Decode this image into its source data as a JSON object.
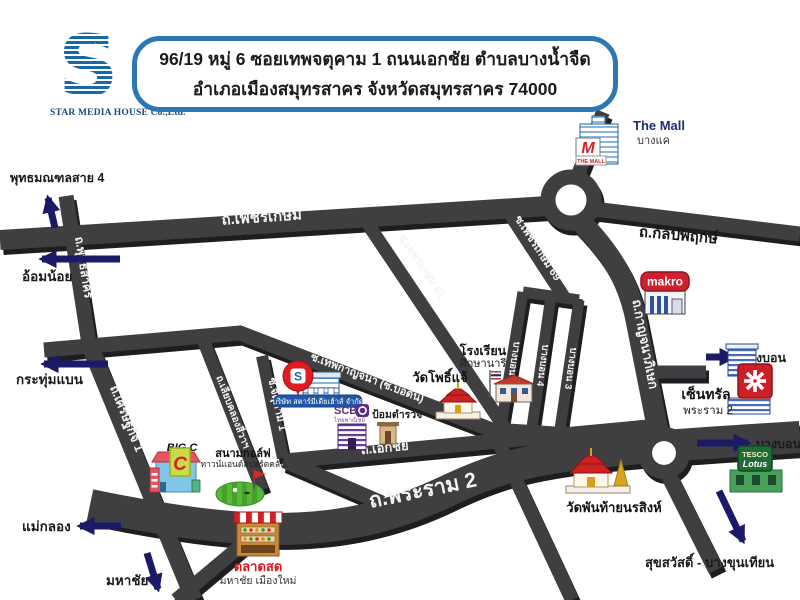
{
  "header": {
    "logo_letter": "S",
    "logo_star": "★",
    "company": "STAR MEDIA HOUSE Co.,Ltd.",
    "address_line1": "96/19 หมู่ 6 ซอยเทพจตุคาม 1 ถนนเอกชัย ตำบลบางน้ำจืด",
    "address_line2": "อำเภอเมืองสมุทรสาคร จังหวัดสมุทรสาคร 74000"
  },
  "roads": {
    "phetkasem": "ถ.เพชรเกษม",
    "kanlapaphruek": "ถ.กัลปพฤกษ์",
    "kanchanaphisek": "ถ.กาญจนาภิเษก",
    "phetkasem81": "ซ.เพชรเกษม 81",
    "phetkasem69": "ซ.เพชรเกษม 69",
    "bangbon5": "บางบอน 5",
    "bangbon4": "บางบอน 4",
    "bangbon3": "บางบอน 3",
    "thepkanchana": "ซ.เทพกาญจนา (ซ.บ่อดิน)",
    "ekkachai": "ถ.เอกชัย",
    "rama2": "ถ.พระราม 2",
    "phuttasakhon": "ถ.พุทธสาคร",
    "setthakit1": "ถ.เศรษฐกิจ 1",
    "chatukham1": "ซ.จตุคาม 1",
    "liapkhlong": "ถ.เลียบคลองสี่วาฯ"
  },
  "directions": {
    "phutthamonthon4": "พุทธมณฑลสาย 4",
    "omnoi": "อ้อมน้อย",
    "krathumbaen": "กระทุ่มแบน",
    "maeklong": "แม่กลอง",
    "mahachai": "มหาชัย",
    "bangbon": "บางบอน",
    "suksawat": "สุขสวัสดิ์ - บางขุนเทียน"
  },
  "landmarks": {
    "the_mall": {
      "name": "The Mall",
      "sub": "บางแค",
      "sign": "THE MALL",
      "logo_letter": "M"
    },
    "makro": {
      "sign": "makro"
    },
    "central": {
      "name": "เซ็นทรัล",
      "sub": "พระราม 2"
    },
    "tesco": {
      "sign1": "TESCO",
      "sign2": "Lotus"
    },
    "bigc": {
      "name": "BIG C",
      "sign_letter": "C"
    },
    "golf": {
      "name": "สนามกอล์ฟ",
      "sub": "ทาวน์แอนด์สปอร์ตคลับ"
    },
    "school": {
      "name": "โรงเรียน",
      "sub": "ศึกษานารี"
    },
    "wat_phochae": {
      "name": "วัดโพธิ์แจ้"
    },
    "wat_phanthai": {
      "name": "วัดพันท้ายนรสิงห์"
    },
    "market": {
      "name": "ตลาดสด",
      "sub": "มหาชัย เมืองใหม่"
    },
    "star_media": {
      "label": "บริษัท สตาร์มีเดียเฮ้าส์ จำกัด",
      "logo_letter": "S"
    },
    "scb": {
      "name": "SCB",
      "sub": "ไทยพาณิชย์"
    },
    "police": {
      "name": "ป้อมตำรวจ"
    }
  },
  "colors": {
    "header_border": "#2d77b2",
    "logo_blue": "#186aa5",
    "road_face": "#3f3f42",
    "road_shadow": "#1e1e21",
    "arrow_navy": "#1a1a66",
    "brand_red": "#d41f26",
    "scb_purple": "#5a2d82"
  }
}
